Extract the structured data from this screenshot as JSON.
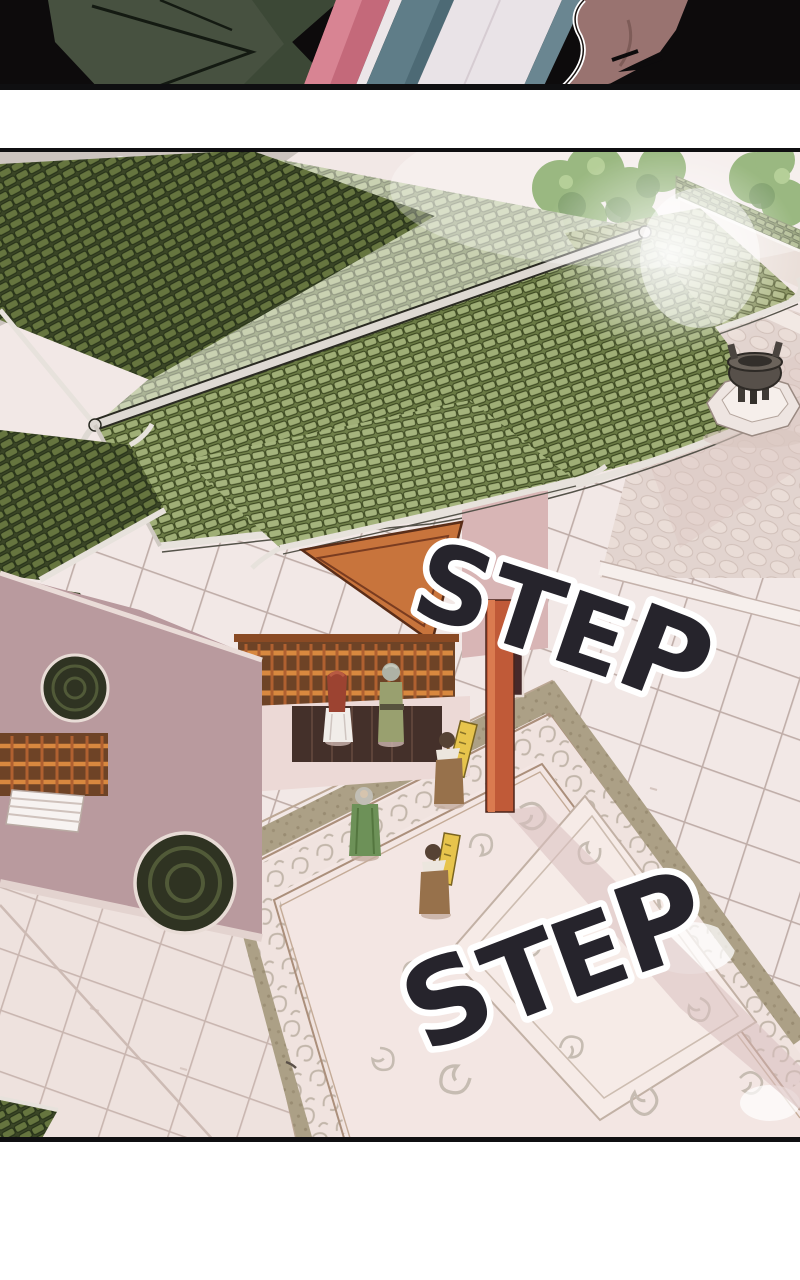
{
  "page": {
    "kind": "webtoon episode segment",
    "background": "#ffffff",
    "gutter_color": "#ffffff",
    "panel_border_color": "#0f0f11"
  },
  "previous_panel": {
    "description": "Bottom sliver of the previous panel: close-up of two characters, striped robes of pink, teal and pale lavender between them, dark silhouette at right",
    "colors": {
      "backdrop_black": "#0d0b0c",
      "shoulder_green": "#475140",
      "shoulder_green_shaded": "#3c4836",
      "robe_stripe_pink": "#c4697a",
      "robe_stripe_teal": "#5f7d88",
      "robe_stripe_pale": "#e9e3e7",
      "hair_brown": "#997370"
    }
  },
  "main_panel": {
    "description": "Bird's-eye view of a palace temple courtyard: sweeping green glazed-tile roofs, pink walls with orange woodwork, a bronze incense burner on an octagonal pedestal, an ornate scroll-carved walkway, and tiny figures crossing the plaza",
    "sfx": {
      "step1": {
        "text": "STEP",
        "letters": [
          "S",
          "T",
          "E",
          "P"
        ],
        "rotation_deg": 18,
        "fill": "#26242c",
        "outline": "#ffffff"
      },
      "step2": {
        "text": "STEP",
        "letters": [
          "S",
          "T",
          "E",
          "P"
        ],
        "rotation_deg": -21,
        "fill": "#26242c",
        "outline": "#ffffff"
      }
    },
    "palette": {
      "roof_tile_light": "#9fae76",
      "roof_tile_dark": "#6a7a46",
      "roof_gap": "#46542c",
      "ridge_trim": "#e7e2dc",
      "gable_orange": "#c8743c",
      "pillar_red": "#c05a38",
      "wall_pink": "#d8b5b5",
      "wall_mauve": "#b99a9e",
      "plaza_tile": "#f2e8e6",
      "tile_line": "#b7a49e",
      "stone_gray": "#ccc4bf",
      "carpet_field": "#f3e6e3",
      "carpet_band": "#aca086",
      "carpet_line": "#ab8f7b",
      "scroll_gray": "#c6bcb2",
      "tree_green": "#6f9a4b",
      "burner_bronze": "#57504a",
      "banner_gold": "#e7c44c"
    },
    "figures": [
      {
        "name": "red-haired woman in white robe",
        "position": "upper courtyard, walking"
      },
      {
        "name": "grey-haired man in olive robe",
        "position": "upper courtyard, walking beside her"
      },
      {
        "name": "elder in green robe",
        "position": "left edge of carved walkway"
      },
      {
        "name": "banner bearer in brown robe with gold standard",
        "position": "middle of carved walkway"
      },
      {
        "name": "banner bearer in brown robe with gold standard",
        "position": "lower carved walkway"
      }
    ],
    "props": [
      {
        "name": "bronze incense burner on octagonal pedestal",
        "position": "upper-right plaza"
      },
      {
        "name": "ornate scroll-carved walkway",
        "position": "lower-right plaza"
      },
      {
        "name": "circular lattice window medallions",
        "position": "left hall wall"
      }
    ]
  }
}
